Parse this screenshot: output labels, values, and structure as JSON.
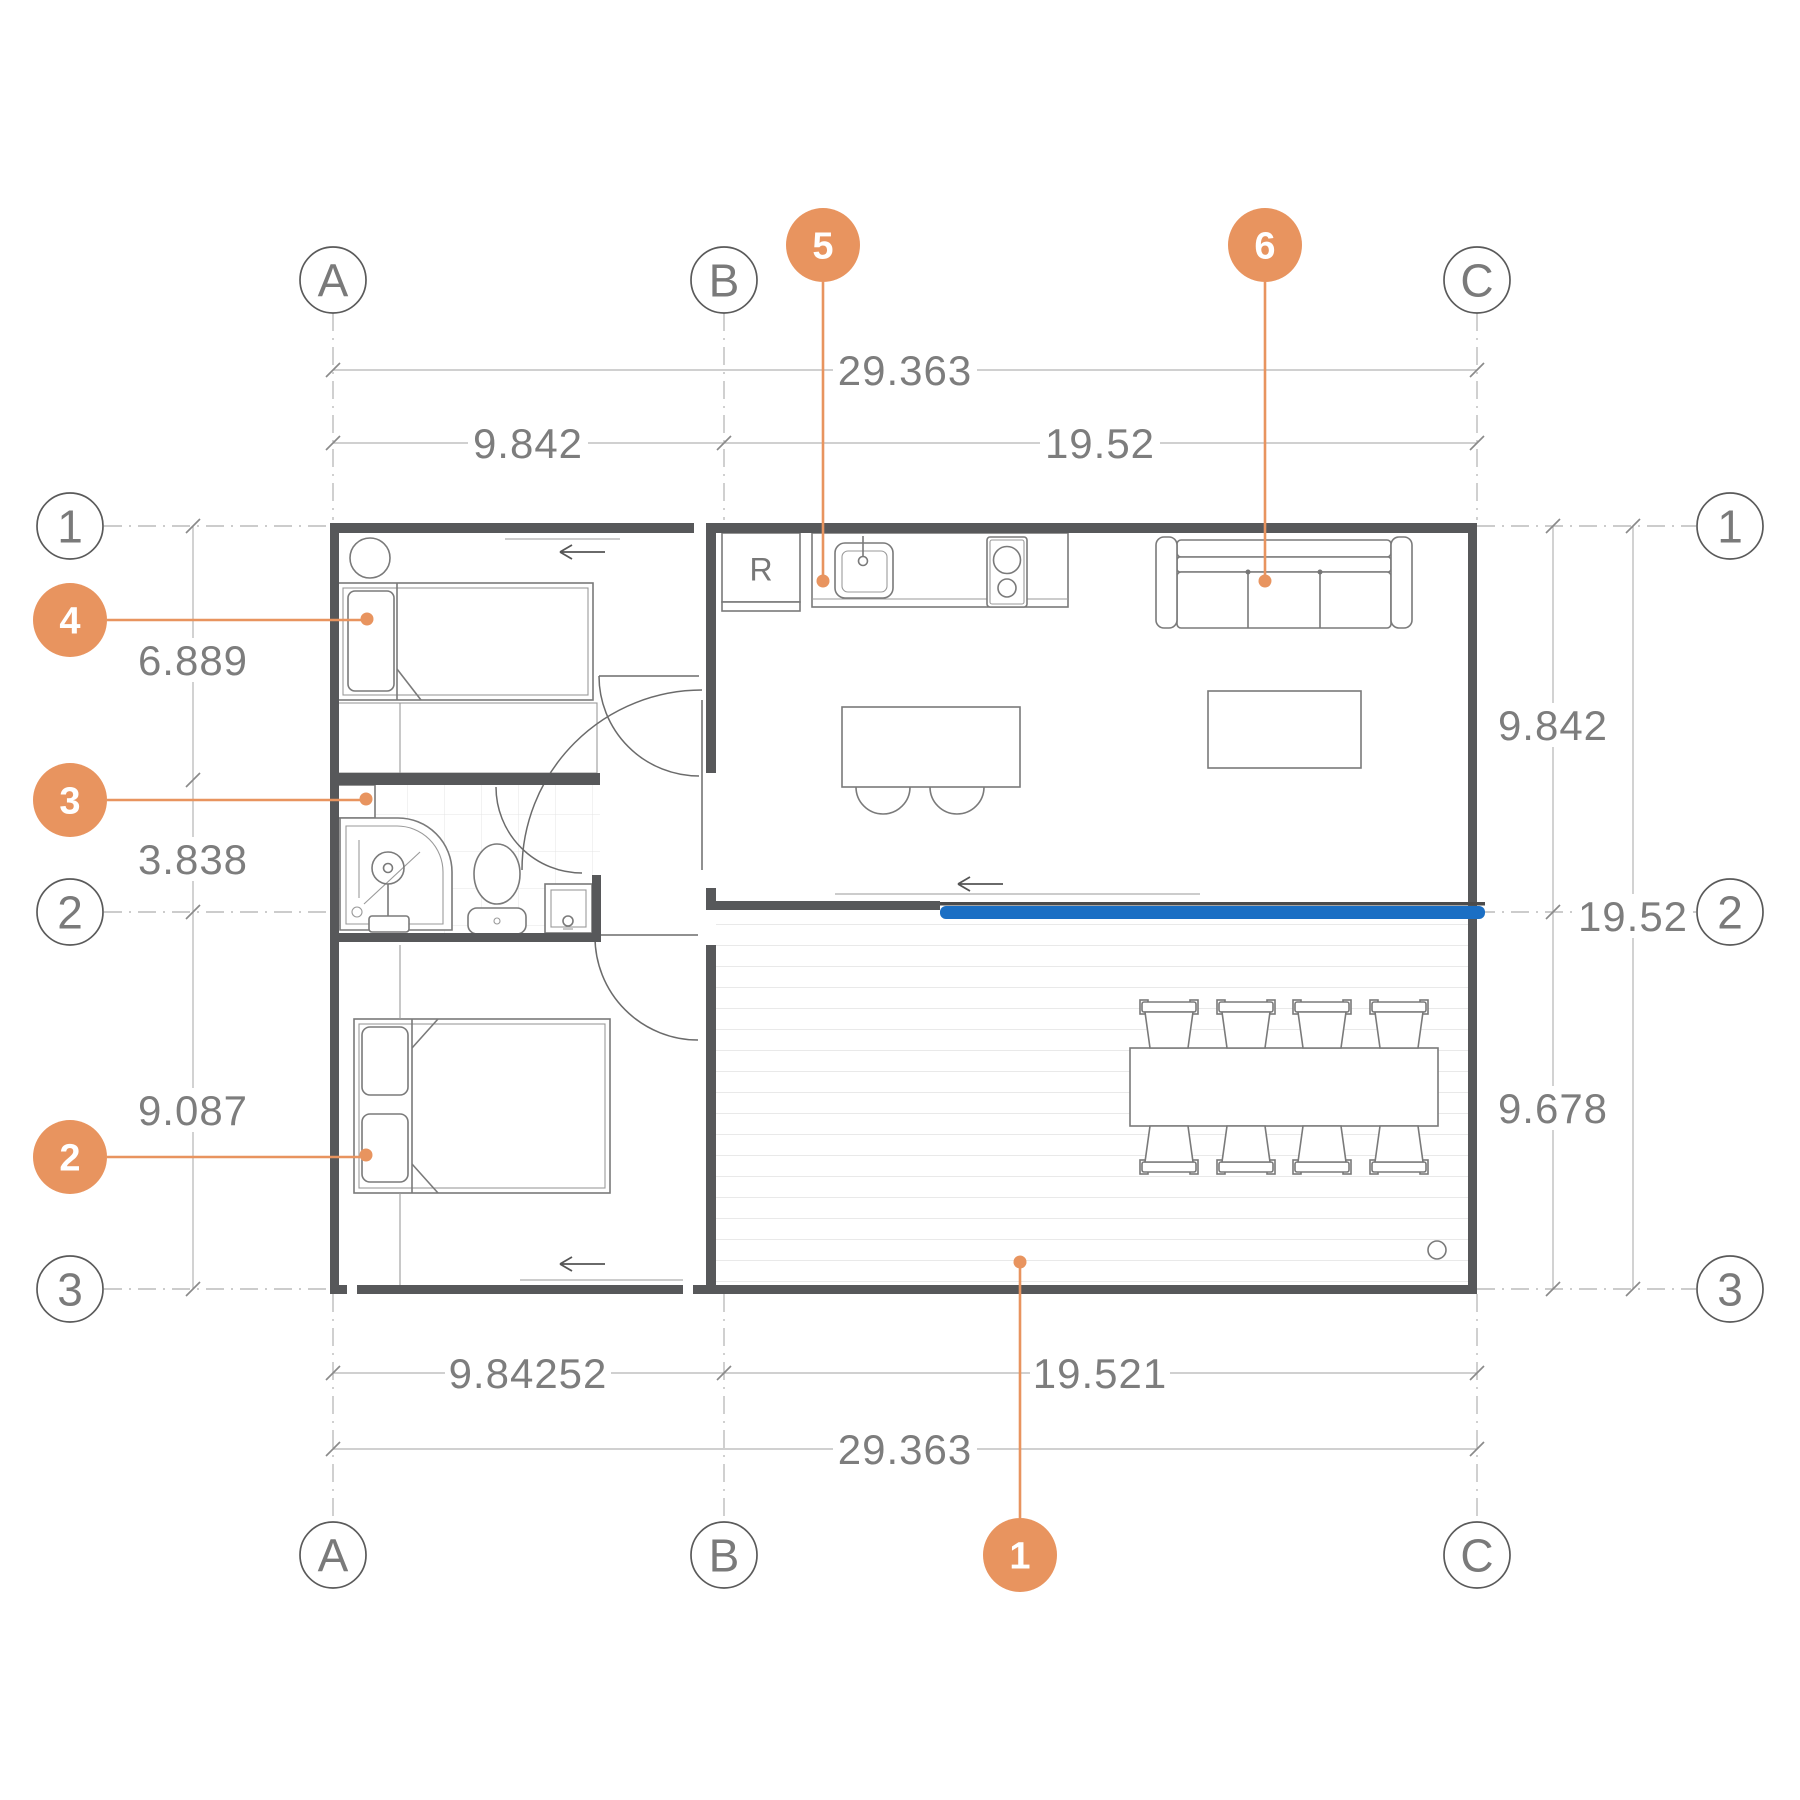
{
  "plan": {
    "colors": {
      "accent_orange": "#E8945F",
      "door_highlight_blue": "#1B6FC4",
      "wall_gray": "#57585A",
      "dim_text_gray": "#7D7D7D"
    },
    "grid": {
      "cols": [
        {
          "label": "A"
        },
        {
          "label": "B"
        },
        {
          "label": "C"
        }
      ],
      "rows": [
        {
          "label": "1"
        },
        {
          "label": "2"
        },
        {
          "label": "3"
        }
      ]
    },
    "dimensions": {
      "top_total": "29.363",
      "top_left": "9.842",
      "top_right": "19.52",
      "left": [
        "6.889",
        "3.838",
        "9.087"
      ],
      "right": [
        "9.842",
        "19.52",
        "9.678"
      ],
      "bottom_left": "9.84252",
      "bottom_right": "19.521",
      "bottom_total": "29.363"
    },
    "callouts": [
      {
        "num": "1",
        "target": "deck"
      },
      {
        "num": "2",
        "target": "bedroom-2-bed"
      },
      {
        "num": "3",
        "target": "bathroom"
      },
      {
        "num": "4",
        "target": "bedroom-1-bed"
      },
      {
        "num": "5",
        "target": "kitchen-counter-sink"
      },
      {
        "num": "6",
        "target": "sofa"
      }
    ],
    "kitchen": {
      "fridge_label": "R"
    }
  }
}
